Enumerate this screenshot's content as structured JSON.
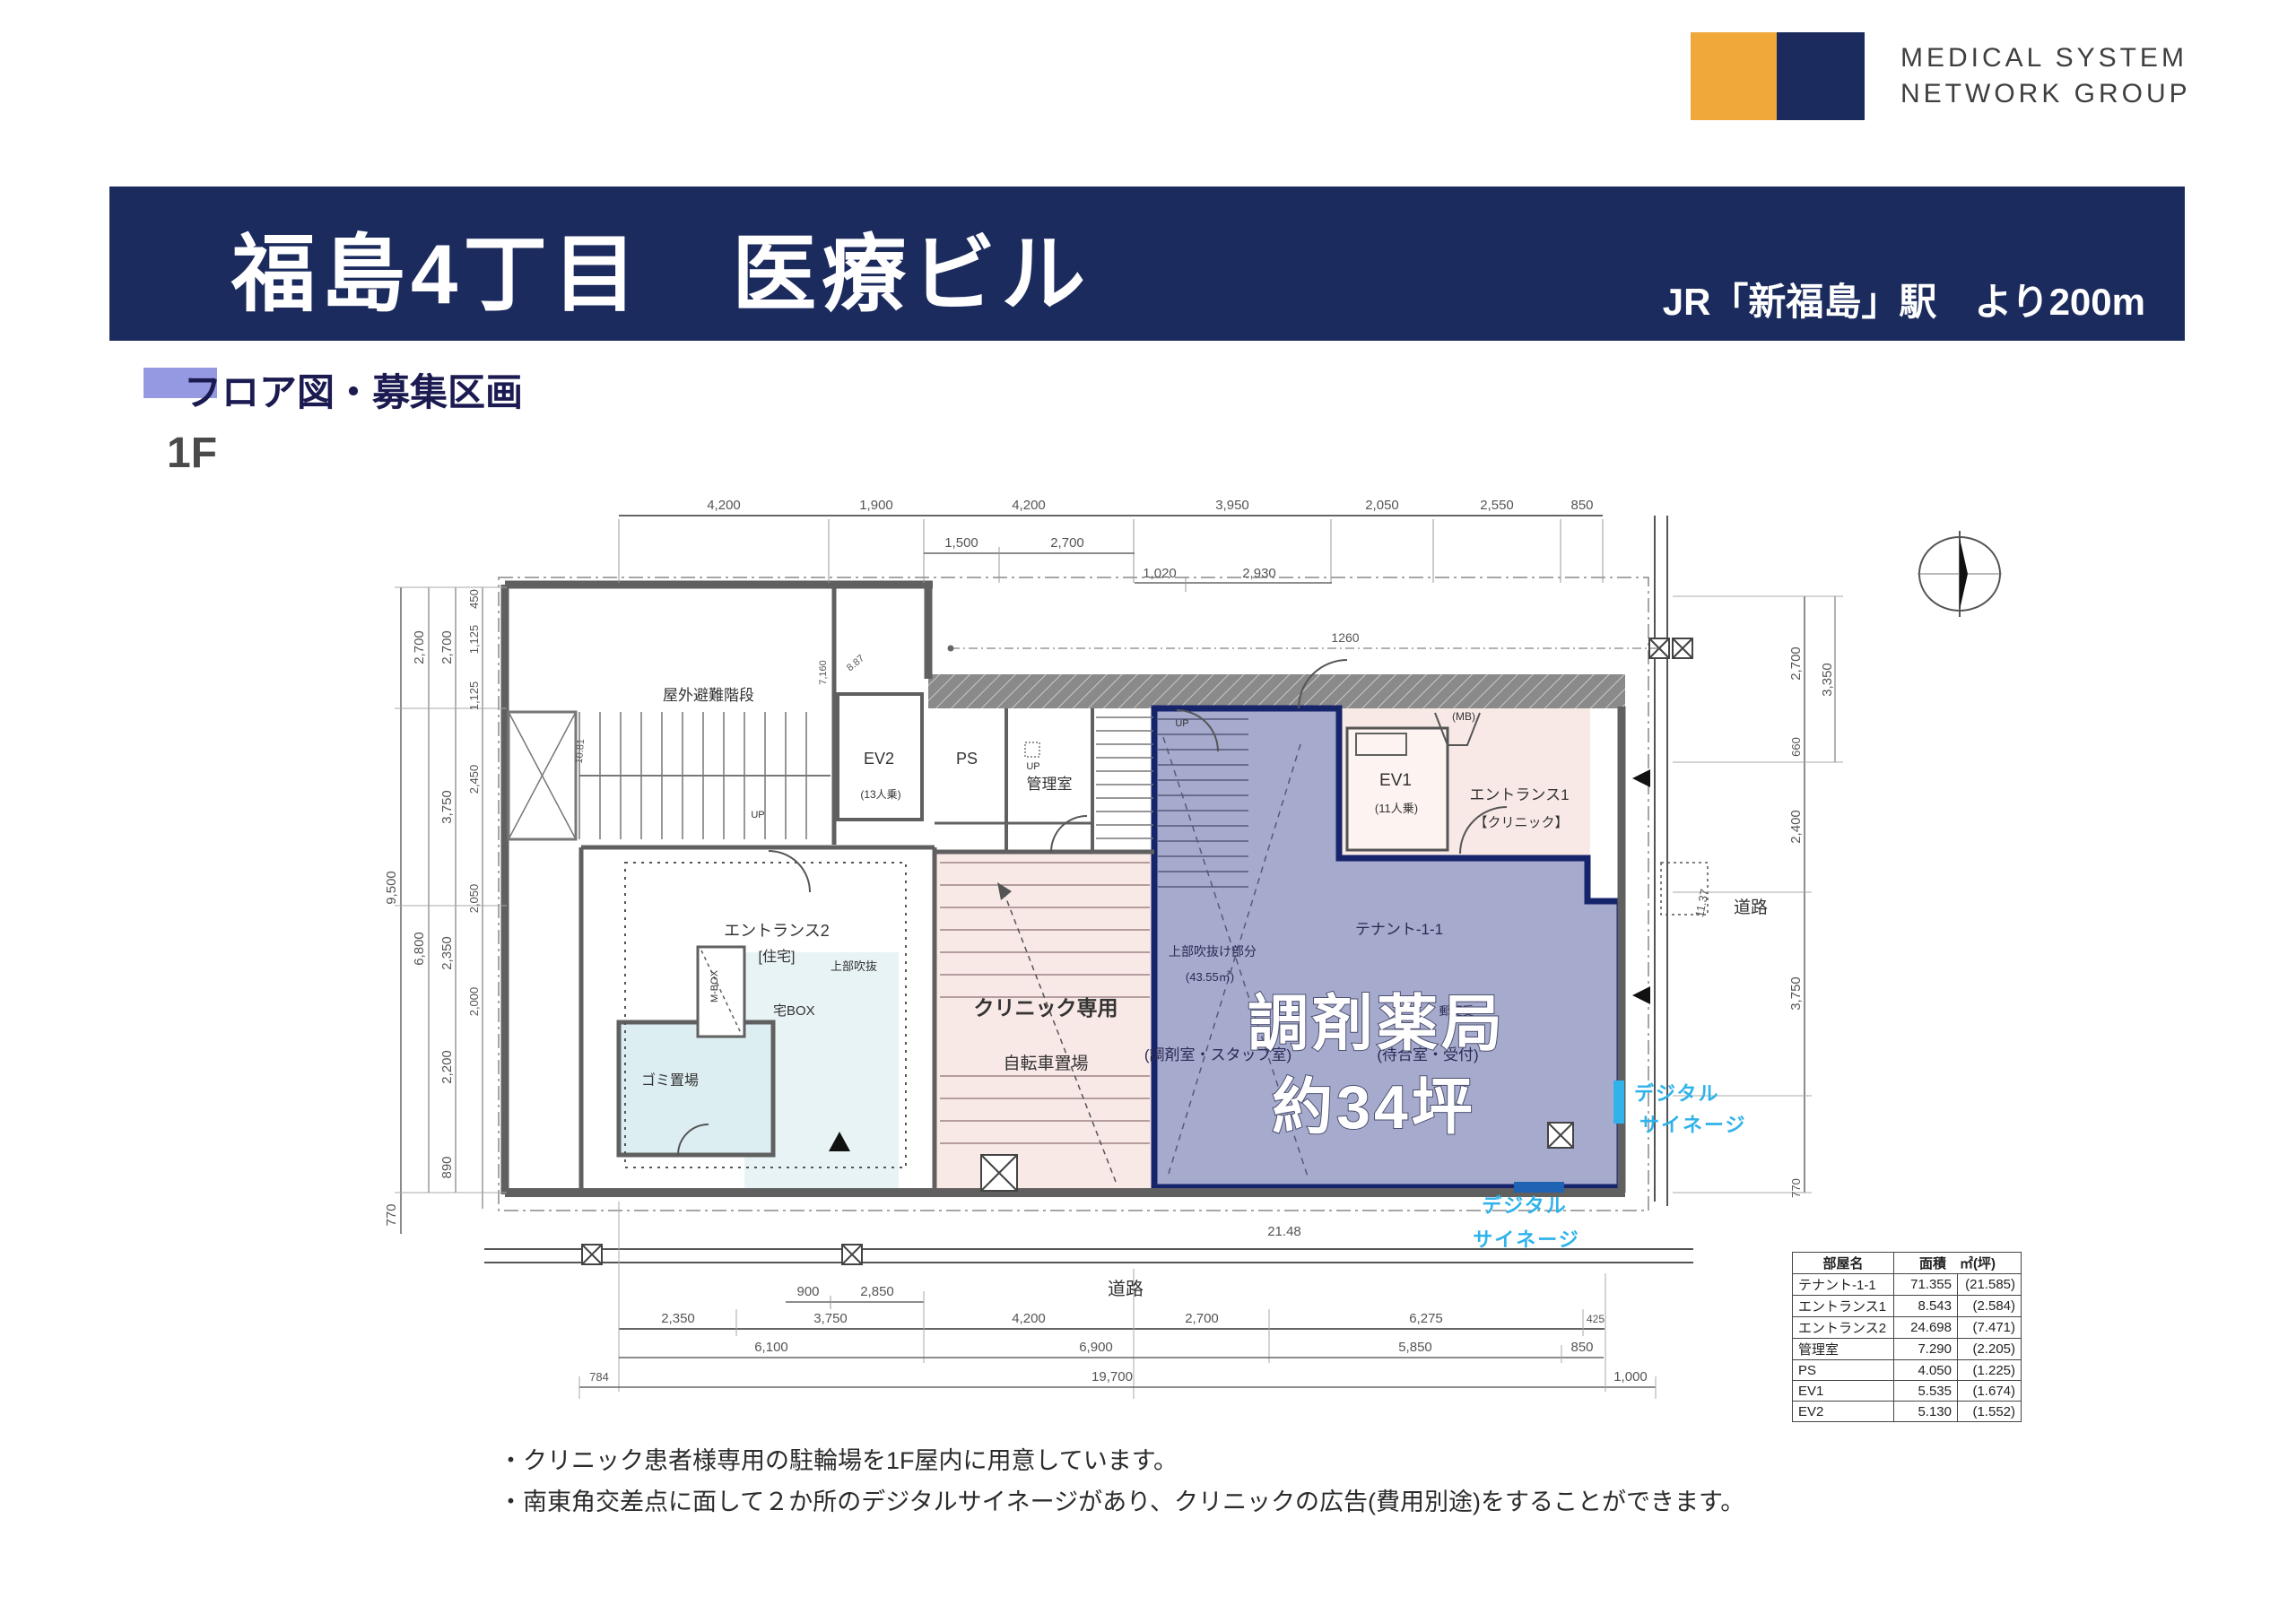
{
  "logo": {
    "line1": "MEDICAL SYSTEM",
    "line2": "NETWORK GROUP"
  },
  "header": {
    "title": "福島4丁目　医療ビル",
    "station": "JR「新福島」駅　より200m"
  },
  "section": {
    "heading": "フロア図・募集区画",
    "floor": "1F"
  },
  "colors": {
    "brand_navy": "#1c2b5e",
    "brand_orange": "#f1a83a",
    "heading_lavender": "#9599e2",
    "highlight_purple": "#a6aacc",
    "highlight_border": "#16246b",
    "clinic_pink": "#f8e9e7",
    "service_blue": "#ddeef2",
    "signage_cyan": "#2fb3ea"
  },
  "plan": {
    "labels": {
      "escape_stairs": "屋外避難階段",
      "ev2": "EV2",
      "ev2_cap": "(13人乗)",
      "ps": "PS",
      "admin_room": "管理室",
      "up": "UP",
      "entrance2": "エントランス2",
      "entrance2_type": "[住宅]",
      "void_note": "上部吹抜",
      "mbox": "M-BOX",
      "parcel_box": "宅BOX",
      "garbage": "ゴミ置場",
      "clinic_only": "クリニック専用",
      "bicycle": "自転車置場",
      "mb": "(MB)",
      "ev1": "EV1",
      "ev1_cap": "(11人乗)",
      "entrance1": "エントランス1",
      "entrance1_type": "【クリニック】",
      "tenant_id": "テナント-1-1",
      "mailbox": "郵便受",
      "upper_void": "上部吹抜け部分",
      "upper_void_area": "(43.55㎡)",
      "dispensing": "(調剤室・スタッフ室)",
      "waiting": "(待合室・受付)"
    },
    "highlight": {
      "line1": "調剤薬局",
      "line2": "約34坪"
    },
    "signage": {
      "line1": "デジタル",
      "line2": "サイネージ"
    },
    "roads": {
      "right": "道路",
      "bottom": "道路"
    },
    "dims": {
      "top1": [
        "4,200",
        "1,900",
        "4,200",
        "3,950",
        "2,050",
        "2,550",
        "850"
      ],
      "top2": [
        "1,500",
        "2,700"
      ],
      "top3": [
        "1,020",
        "2,930"
      ],
      "diag": "1260",
      "left_a": [
        "9,500",
        "770"
      ],
      "left_b": [
        "2,700",
        "6,800"
      ],
      "left_c": [
        "2,700",
        "3,750",
        "2,350",
        "2,200",
        "890"
      ],
      "left_d": [
        "450",
        "1,125",
        "1,125",
        "2,450",
        "2,050",
        "2,000"
      ],
      "right_a": [
        "2,700",
        "660",
        "2,400",
        "3,750",
        "770"
      ],
      "right_b": [
        "3,350"
      ],
      "bottom1": [
        "900",
        "2,850"
      ],
      "bottom2": [
        "2,350",
        "3,750",
        "4,200",
        "2,700",
        "6,275",
        "425"
      ],
      "bottom3": [
        "6,100",
        "6,900",
        "5,850",
        "850"
      ],
      "bottom4": [
        "784",
        "19,700",
        "1,000"
      ],
      "len_2148": "21.48",
      "len_1137": "11.37",
      "len_1081": "10.81",
      "len_887": "8.87",
      "len_7160": "7,160"
    }
  },
  "table": {
    "headers": {
      "room": "部屋名",
      "area": "面積　㎡(坪)"
    },
    "rows": [
      {
        "name": "テナント-1-1",
        "area": "71.355",
        "tsubo": "(21.585)"
      },
      {
        "name": "エントランス1",
        "area": "8.543",
        "tsubo": "(2.584)"
      },
      {
        "name": "エントランス2",
        "area": "24.698",
        "tsubo": "(7.471)"
      },
      {
        "name": "管理室",
        "area": "7.290",
        "tsubo": "(2.205)"
      },
      {
        "name": "PS",
        "area": "4.050",
        "tsubo": "(1.225)"
      },
      {
        "name": "EV1",
        "area": "5.535",
        "tsubo": "(1.674)"
      },
      {
        "name": "EV2",
        "area": "5.130",
        "tsubo": "(1.552)"
      }
    ]
  },
  "notes": {
    "line1": "・クリニック患者様専用の駐輪場を1F屋内に用意しています。",
    "line2": "・南東角交差点に面して２か所のデジタルサイネージがあり、クリニックの広告(費用別途)をすることができます。"
  }
}
